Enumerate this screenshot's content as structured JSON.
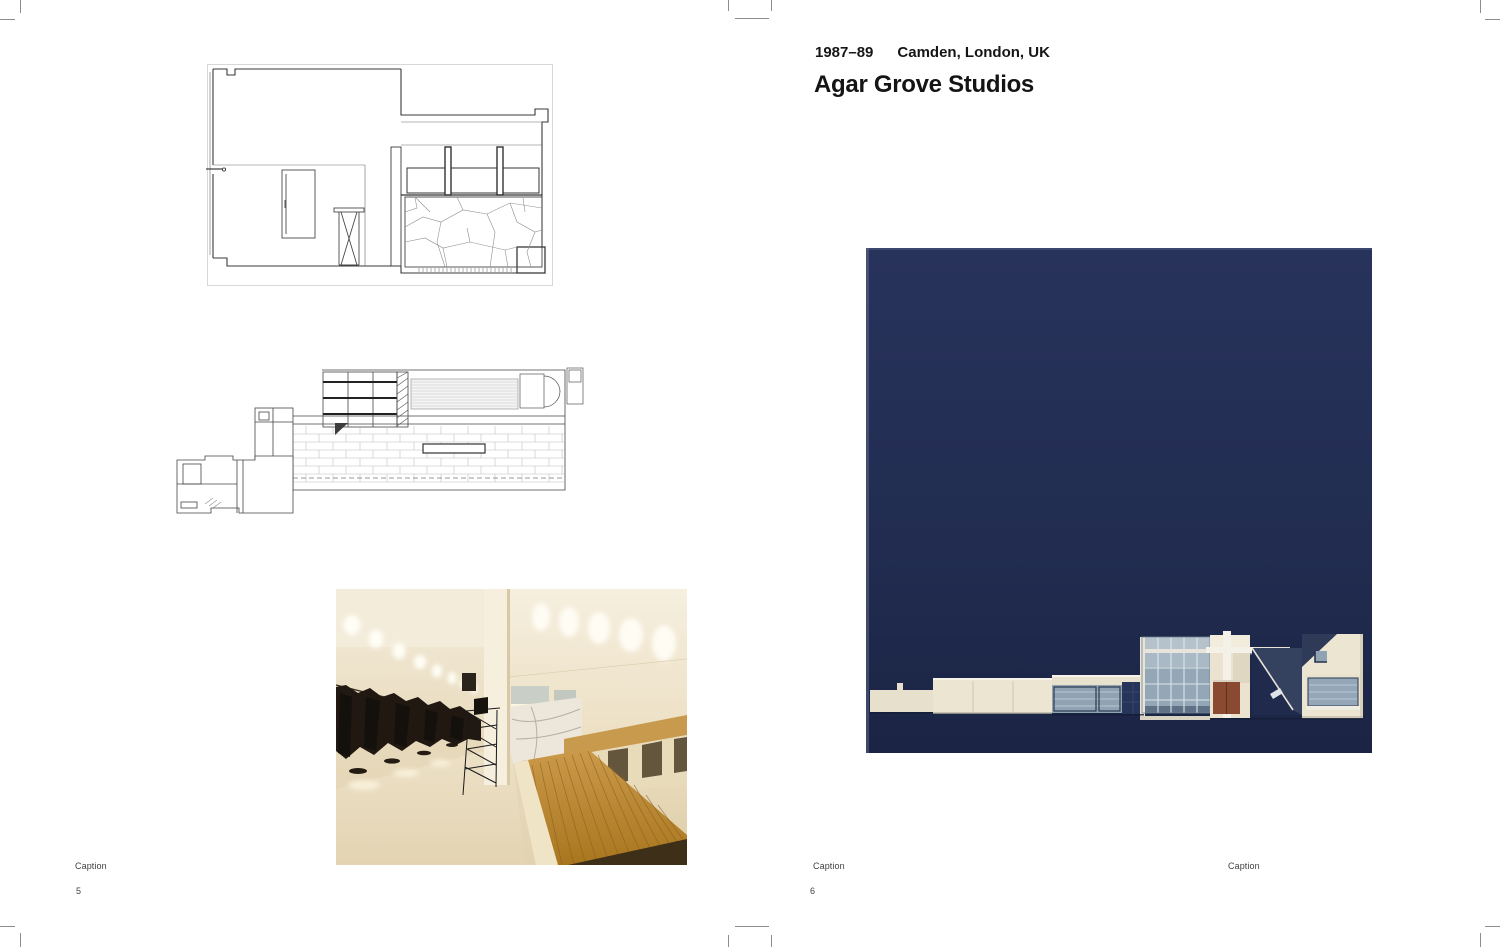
{
  "header": {
    "dates": "1987–89",
    "location": "Camden, London, UK",
    "title": "Agar Grove Studios"
  },
  "left_page": {
    "caption": "Caption",
    "page_number": "5"
  },
  "right_page": {
    "caption": "Caption",
    "caption_right": "Caption",
    "page_number": "6"
  },
  "colors": {
    "navy_background": "#222d52",
    "building_cream": "#ece5d2",
    "door_rust": "#8a4931",
    "glass_blue": "#93a7b7",
    "wood_deck": "#c08a3e",
    "crop_mark_gray": "#8c8c8c"
  }
}
